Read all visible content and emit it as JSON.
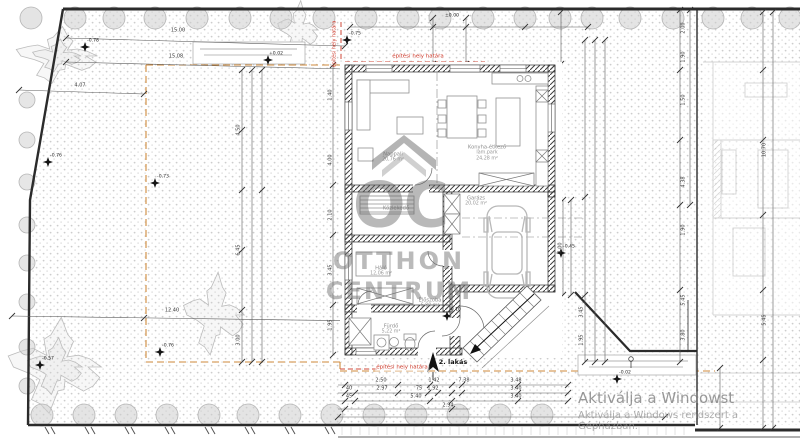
{
  "watermark": {
    "logo": "OC",
    "line1": "OTTHON",
    "line2": "CENTRUM"
  },
  "windows_activation": {
    "line1": "Aktiválja a Windowst",
    "line2": "Aktiválja a Windows rendszert a Gépházban."
  },
  "labels": [
    {
      "t": "15.00",
      "x": 178,
      "y": 31,
      "c": "dim"
    },
    {
      "t": "15.08",
      "x": 176,
      "y": 57,
      "c": "dim"
    },
    {
      "t": "4.07",
      "x": 80,
      "y": 86,
      "c": "dim"
    },
    {
      "t": "12.40",
      "x": 172,
      "y": 311,
      "c": "dim"
    },
    {
      "t": "2.50",
      "x": 381,
      "y": 381,
      "c": "dim"
    },
    {
      "t": "1.42",
      "x": 434,
      "y": 381,
      "c": "dim"
    },
    {
      "t": "7.38",
      "x": 464,
      "y": 381,
      "c": "dim"
    },
    {
      "t": "3.48",
      "x": 516,
      "y": 381,
      "c": "dim"
    },
    {
      "t": "40",
      "x": 349,
      "y": 389,
      "c": "dim"
    },
    {
      "t": "2.97",
      "x": 382,
      "y": 389,
      "c": "dim"
    },
    {
      "t": "75",
      "x": 419,
      "y": 389,
      "c": "dim"
    },
    {
      "t": "1.92",
      "x": 433,
      "y": 389,
      "c": "dim"
    },
    {
      "t": "3.40",
      "x": 516,
      "y": 389,
      "c": "dim"
    },
    {
      "t": "45",
      "x": 349,
      "y": 397,
      "c": "dim"
    },
    {
      "t": "5.40",
      "x": 416,
      "y": 397,
      "c": "dim"
    },
    {
      "t": "3.40",
      "x": 516,
      "y": 397,
      "c": "dim"
    },
    {
      "t": "2.94",
      "x": 448,
      "y": 406,
      "c": "dim"
    },
    {
      "t": "4.50",
      "x": 239,
      "y": 130,
      "c": "dimv",
      "r": -90
    },
    {
      "t": "6.45",
      "x": 239,
      "y": 250,
      "c": "dimv",
      "r": -90
    },
    {
      "t": "3.00",
      "x": 239,
      "y": 340,
      "c": "dimv",
      "r": -90
    },
    {
      "t": "1.40",
      "x": 331,
      "y": 95,
      "c": "dimv",
      "r": -90
    },
    {
      "t": "4.00",
      "x": 331,
      "y": 160,
      "c": "dimv",
      "r": -90
    },
    {
      "t": "2.10",
      "x": 331,
      "y": 215,
      "c": "dimv",
      "r": -90
    },
    {
      "t": "3.45",
      "x": 331,
      "y": 270,
      "c": "dimv",
      "r": -90
    },
    {
      "t": "1.95",
      "x": 331,
      "y": 325,
      "c": "dimv",
      "r": -90
    },
    {
      "t": "3.45",
      "x": 582,
      "y": 312,
      "c": "dimv",
      "r": -90
    },
    {
      "t": "1.95",
      "x": 582,
      "y": 340,
      "c": "dimv",
      "r": -90
    },
    {
      "t": "4.00",
      "x": 561,
      "y": 248,
      "c": "dimv",
      "r": -90
    },
    {
      "t": "2.00",
      "x": 684,
      "y": 28,
      "c": "dimv",
      "r": -90
    },
    {
      "t": "1.90",
      "x": 684,
      "y": 57,
      "c": "dimv",
      "r": -90
    },
    {
      "t": "1.50",
      "x": 684,
      "y": 100,
      "c": "dimv",
      "r": -90
    },
    {
      "t": "4.38",
      "x": 684,
      "y": 182,
      "c": "dimv",
      "r": -90
    },
    {
      "t": "1.90",
      "x": 684,
      "y": 230,
      "c": "dimv",
      "r": -90
    },
    {
      "t": "5.45",
      "x": 684,
      "y": 300,
      "c": "dimv",
      "r": -90
    },
    {
      "t": "3.80",
      "x": 684,
      "y": 335,
      "c": "dimv",
      "r": -90
    },
    {
      "t": "10.70",
      "x": 765,
      "y": 150,
      "c": "dimv",
      "r": -90
    },
    {
      "t": "5.45",
      "x": 765,
      "y": 320,
      "c": "dimv",
      "r": -90
    },
    {
      "t": "-0.78",
      "x": 93,
      "y": 42,
      "c": "elev"
    },
    {
      "t": "-0.76",
      "x": 56,
      "y": 157,
      "c": "elev"
    },
    {
      "t": "-0.73",
      "x": 163,
      "y": 178,
      "c": "elev"
    },
    {
      "t": "-0.75",
      "x": 355,
      "y": 35,
      "c": "elev"
    },
    {
      "t": "+0.02",
      "x": 276,
      "y": 55,
      "c": "elev"
    },
    {
      "t": "-0.57",
      "x": 48,
      "y": 360,
      "c": "elev"
    },
    {
      "t": "-0.76",
      "x": 168,
      "y": 347,
      "c": "elev"
    },
    {
      "t": "-0.02",
      "x": 625,
      "y": 374,
      "c": "elev"
    },
    {
      "t": "-0.45",
      "x": 569,
      "y": 248,
      "c": "elev"
    },
    {
      "t": "±0.00",
      "x": 452,
      "y": 17,
      "c": "elev"
    },
    {
      "t": "-0.10",
      "x": 455,
      "y": 311,
      "c": "elev"
    },
    {
      "t": "építési hely határa",
      "x": 418,
      "y": 57,
      "c": "red"
    },
    {
      "t": "építési hely határa",
      "x": 402,
      "y": 368,
      "c": "red"
    },
    {
      "t": "építési hely határa",
      "x": 335,
      "y": 44,
      "c": "redv",
      "r": -90
    },
    {
      "t": "2. lakás",
      "x": 453,
      "y": 362,
      "c": "north"
    },
    {
      "t": "Nappali",
      "x": 393,
      "y": 155,
      "c": "room"
    },
    {
      "t": "20,76 m²",
      "x": 393,
      "y": 161,
      "c": "rooma"
    },
    {
      "t": "Konyha-étkező",
      "x": 487,
      "y": 148,
      "c": "room"
    },
    {
      "t": "lam.park",
      "x": 487,
      "y": 154,
      "c": "rooma"
    },
    {
      "t": "24,28 m²",
      "x": 487,
      "y": 160,
      "c": "rooma"
    },
    {
      "t": "Közlekedő",
      "x": 396,
      "y": 209,
      "c": "room"
    },
    {
      "t": "Garázs",
      "x": 476,
      "y": 199,
      "c": "room"
    },
    {
      "t": "20,02 m²",
      "x": 476,
      "y": 205,
      "c": "rooma"
    },
    {
      "t": "Háló",
      "x": 381,
      "y": 269,
      "c": "room"
    },
    {
      "t": "12,06 m²",
      "x": 381,
      "y": 275,
      "c": "rooma"
    },
    {
      "t": "Fürdő",
      "x": 391,
      "y": 327,
      "c": "room"
    },
    {
      "t": "5,22 m²",
      "x": 391,
      "y": 333,
      "c": "rooma"
    },
    {
      "t": "Előszoba",
      "x": 430,
      "y": 301,
      "c": "room"
    },
    {
      "t": "6,80 m²",
      "x": 430,
      "y": 307,
      "c": "rooma"
    }
  ]
}
